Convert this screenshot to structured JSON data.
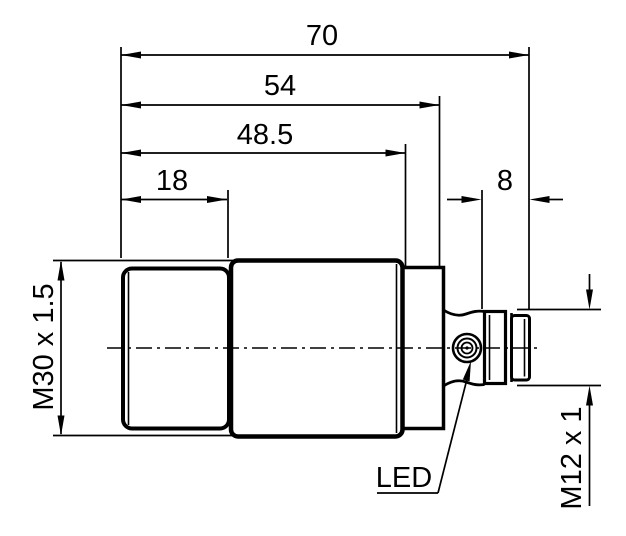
{
  "drawing": {
    "type": "technical-dimension-drawing",
    "subject": "cylindrical sensor side view",
    "colors": {
      "line": "#000000",
      "background": "#ffffff"
    },
    "dimensions": {
      "overall_length": {
        "label": "70"
      },
      "body_with_connector": {
        "label": "54"
      },
      "housing_length": {
        "label": "48.5"
      },
      "thread_length": {
        "label": "18"
      },
      "connector_length": {
        "label": "8"
      },
      "front_thread": {
        "label": "M30 x 1.5"
      },
      "connector_thread": {
        "label": "M12 x 1"
      }
    },
    "callouts": {
      "led_label": "LED"
    }
  }
}
